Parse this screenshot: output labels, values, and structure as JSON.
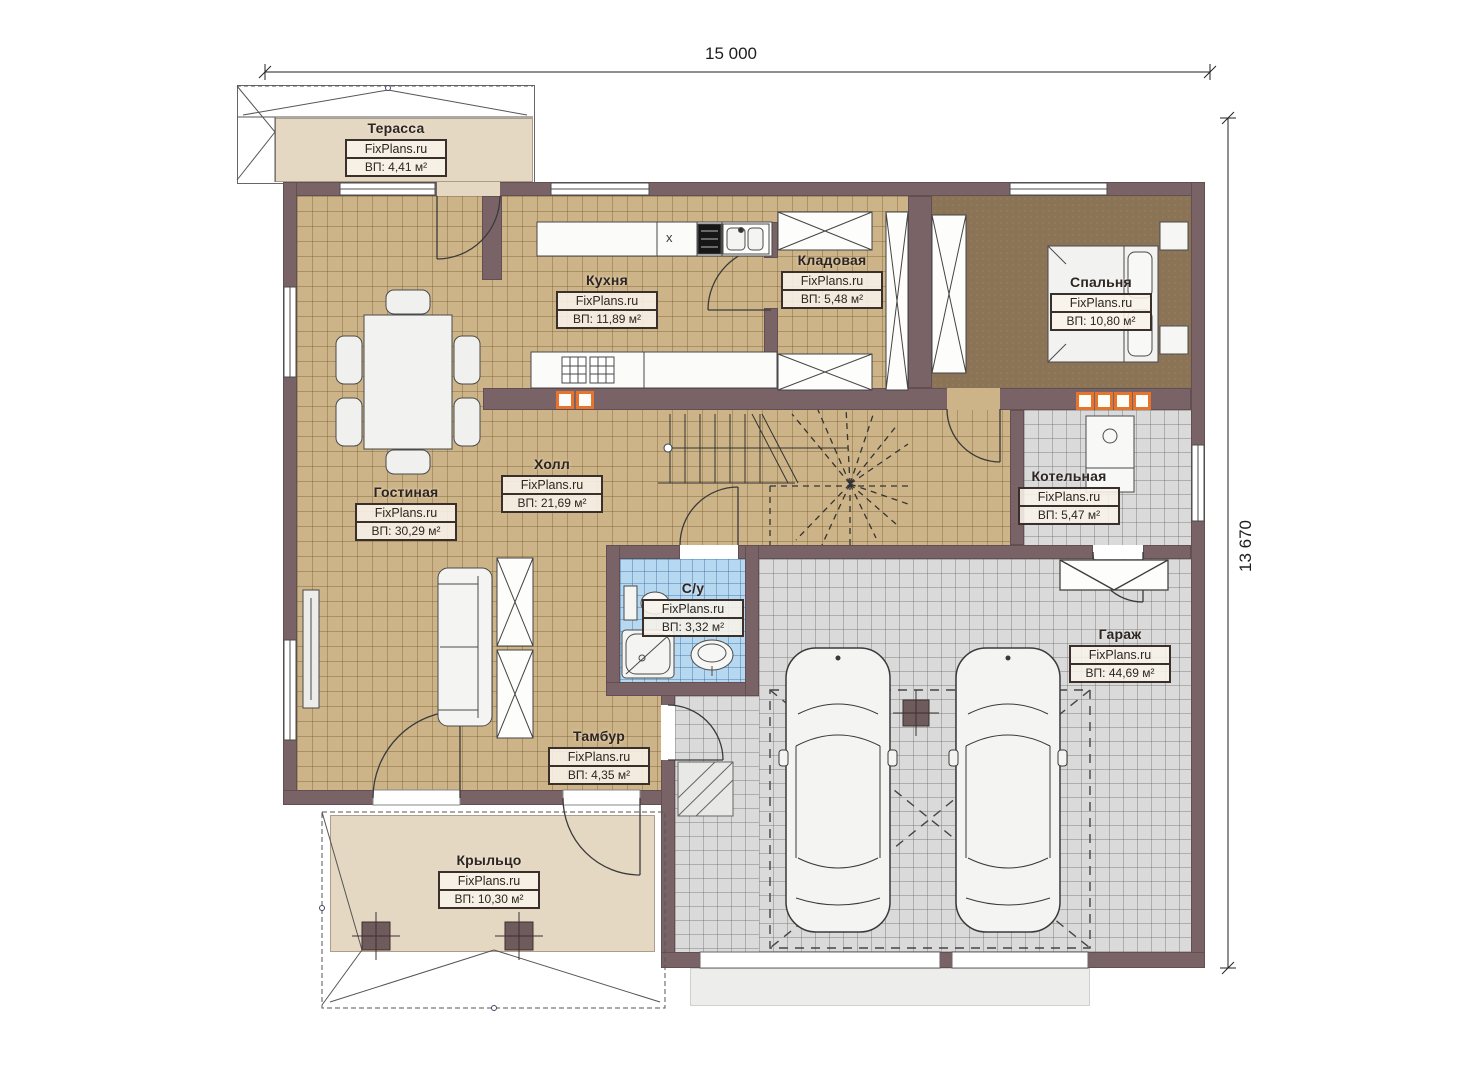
{
  "dimensions": {
    "width": "15 000",
    "height": "13 670"
  },
  "brand": "FixPlans.ru",
  "rooms": {
    "terrace": {
      "name": "Терасса",
      "watermark": "FixPlans.ru",
      "area": "ВП: 4,41 м²"
    },
    "kitchen": {
      "name": "Кухня",
      "watermark": "FixPlans.ru",
      "area": "ВП: 11,89 м²"
    },
    "pantry": {
      "name": "Кладовая",
      "watermark": "FixPlans.ru",
      "area": "ВП: 5,48 м²"
    },
    "bedroom": {
      "name": "Спальня",
      "watermark": "FixPlans.ru",
      "area": "ВП: 10,80 м²"
    },
    "living_room": {
      "name": "Гостиная",
      "watermark": "FixPlans.ru",
      "area": "ВП: 30,29 м²"
    },
    "hall": {
      "name": "Холл",
      "watermark": "FixPlans.ru",
      "area": "ВП: 21,69 м²"
    },
    "boiler_room": {
      "name": "Котельная",
      "watermark": "FixPlans.ru",
      "area": "ВП: 5,47 м²"
    },
    "bathroom": {
      "name": "С/у",
      "watermark": "FixPlans.ru",
      "area": "ВП: 3,32 м²"
    },
    "garage": {
      "name": "Гараж",
      "watermark": "FixPlans.ru",
      "area": "ВП: 44,69 м²"
    },
    "vestibule": {
      "name": "Тамбур",
      "watermark": "FixPlans.ru",
      "area": "ВП: 4,35 м²"
    },
    "porch": {
      "name": "Крыльцо",
      "watermark": "FixPlans.ru",
      "area": "ВП: 10,30 м²"
    }
  },
  "kitchen_cabinet_mark": "x",
  "colors": {
    "wall": "#796366",
    "floor_tile": "#cdb488",
    "bedroom_floor": "#8b7456",
    "tech_floor": "#dadada",
    "bathroom_floor": "#b7d8f1",
    "deck": "#e5d8c3",
    "vent_accent": "#e5752e"
  }
}
